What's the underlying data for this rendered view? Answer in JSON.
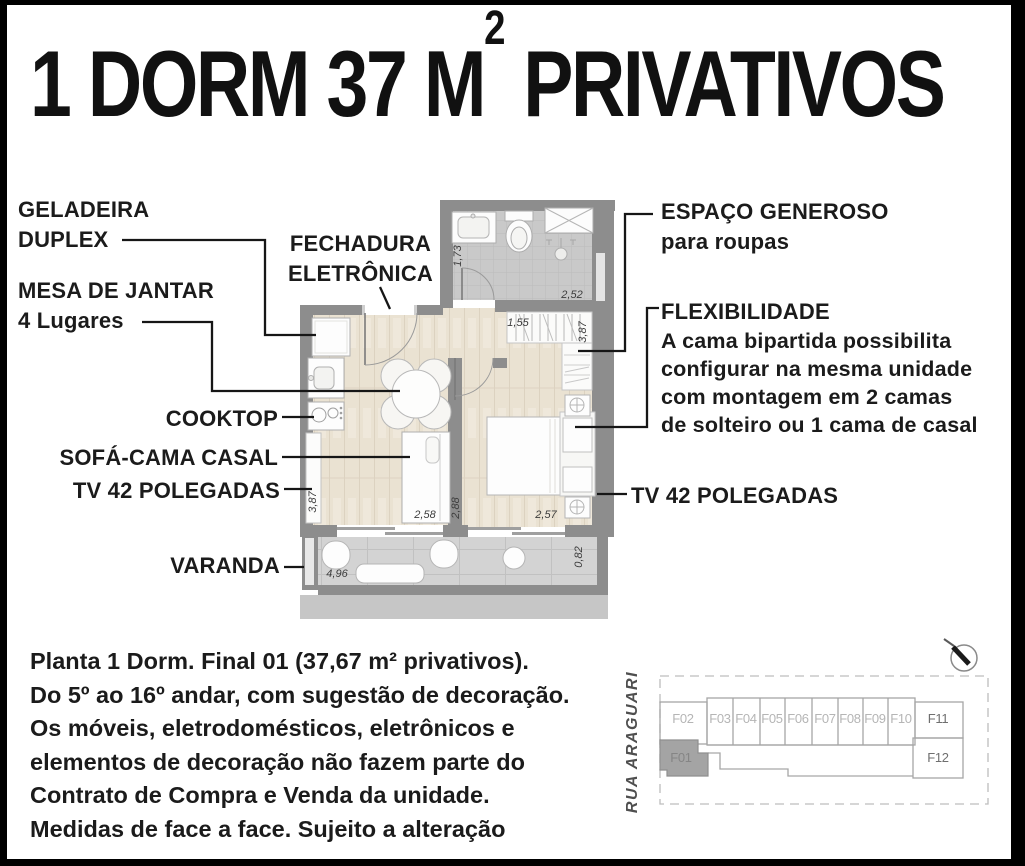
{
  "title": {
    "prefix": "1 DORM 37 M",
    "sup": "2",
    "suffix": " PRIVATIVOS"
  },
  "callouts": {
    "geladeira": {
      "line1": "GELADEIRA",
      "line2": "DUPLEX"
    },
    "mesa": {
      "line1": "MESA DE JANTAR",
      "line2": "4 Lugares"
    },
    "fechadura": {
      "line1": "FECHADURA",
      "line2": "ELETRÔNICA"
    },
    "cooktop": "COOKTOP",
    "sofa_cama": "SOFÁ-CAMA CASAL",
    "tv_living": "TV 42 POLEGADAS",
    "varanda": "VARANDA",
    "espaco": {
      "line1": "ESPAÇO GENEROSO",
      "line2": "para roupas"
    },
    "flexibilidade": {
      "title": "FLEXIBILIDADE",
      "lines": [
        "A cama bipartida possibilita",
        "configurar na mesma unidade",
        "com montagem em 2 camas",
        "de solteiro ou 1 cama de casal"
      ]
    },
    "tv_bedroom": "TV 42 POLEGADAS"
  },
  "dimensions": {
    "bathroom_height": "1,73",
    "bathroom_width": "2,52",
    "closet_width": "1,55",
    "closet_height": "3,87",
    "living_height": "3,87",
    "living_width": "2,58",
    "bedroom_height": "2,88",
    "bedroom_width": "2,57",
    "varanda_width": "4,96",
    "varanda_depth": "0,82"
  },
  "disclaimer": {
    "lines": [
      "Planta 1 Dorm. Final 01 (37,67 m² privativos).",
      "Do 5º ao 16º andar, com sugestão de decoração.",
      "Os móveis, eletrodomésticos, eletrônicos e",
      "elementos de decoração não fazem parte do",
      "Contrato de Compra e Venda da unidade.",
      "Medidas de face a face. Sujeito a alteração"
    ]
  },
  "keyplan": {
    "street": "RUA ARAGUARI",
    "units": [
      "F01",
      "F02",
      "F03",
      "F04",
      "F05",
      "F06",
      "F07",
      "F08",
      "F09",
      "F10",
      "F11",
      "F12"
    ],
    "highlighted_unit": "F01"
  },
  "colors": {
    "wall": "#8d8d8d",
    "wood_floor": "#eae2d2",
    "tile_floor": "#c9c9c9",
    "varanda_floor": "#d3d3d3",
    "leader_line": "#161616",
    "keyplan_highlight": "#a4a4a4"
  }
}
